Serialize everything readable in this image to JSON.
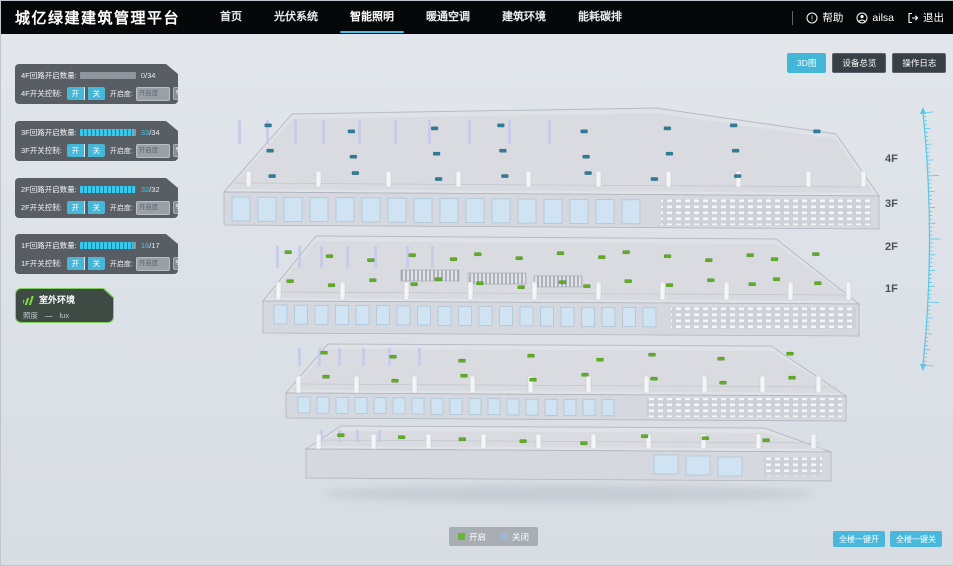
{
  "header": {
    "title": "城亿绿建建筑管理平台",
    "nav": [
      {
        "key": "home",
        "label": "首页",
        "active": false
      },
      {
        "key": "pv-system",
        "label": "光伏系统",
        "active": false
      },
      {
        "key": "smart-lighting",
        "label": "智能照明",
        "active": true
      },
      {
        "key": "hvac",
        "label": "暖通空调",
        "active": false
      },
      {
        "key": "building-env",
        "label": "建筑环境",
        "active": false
      },
      {
        "key": "energy-carbon",
        "label": "能耗碳排",
        "active": false
      }
    ],
    "help_label": "帮助",
    "username": "ailsa",
    "logout_label": "退出"
  },
  "view_buttons": [
    {
      "key": "view-3d",
      "label": "3D图",
      "active": true
    },
    {
      "key": "device-overview",
      "label": "设备总览",
      "active": false
    },
    {
      "key": "operation-log",
      "label": "操作日志",
      "active": false
    }
  ],
  "floor_controls": [
    {
      "key": "4f",
      "circuit_label": "4F回路开启数量:",
      "open_count": 0,
      "total": 34,
      "total_text": "/34",
      "switch_label": "4F开关控制:",
      "on_label": "开",
      "off_label": "关",
      "openness_label": "开启度:",
      "openness_placeholder": "开启度",
      "percent_label": "%"
    },
    {
      "key": "3f",
      "circuit_label": "3F回路开启数量:",
      "open_count": 33,
      "total": 34,
      "total_text": "/34",
      "switch_label": "3F开关控制:",
      "on_label": "开",
      "off_label": "关",
      "openness_label": "开启度:",
      "openness_placeholder": "开启度",
      "percent_label": "%"
    },
    {
      "key": "2f",
      "circuit_label": "2F回路开启数量:",
      "open_count": 32,
      "total": 32,
      "total_text": "/32",
      "switch_label": "2F开关控制:",
      "on_label": "开",
      "off_label": "关",
      "openness_label": "开启度:",
      "openness_placeholder": "开启度",
      "percent_label": "%"
    },
    {
      "key": "1f",
      "circuit_label": "1F回路开启数量:",
      "open_count": 16,
      "total": 17,
      "total_text": "/17",
      "switch_label": "1F开关控制:",
      "on_label": "开",
      "off_label": "关",
      "openness_label": "开启度:",
      "openness_placeholder": "开启度",
      "percent_label": "%"
    }
  ],
  "outdoor": {
    "title": "室外环境",
    "illuminance_label": "照度",
    "illuminance_value": "—",
    "illuminance_unit": "lux"
  },
  "floor_scale_labels": [
    "4F",
    "3F",
    "2F",
    "1F"
  ],
  "legend": [
    {
      "key": "on",
      "label": "开启",
      "color": "#6ab437"
    },
    {
      "key": "off",
      "label": "关闭",
      "color": "#9cb8d8"
    }
  ],
  "bulk_buttons": [
    {
      "key": "all-on",
      "label": "全楼一键开"
    },
    {
      "key": "all-off",
      "label": "全楼一键关"
    }
  ],
  "colors": {
    "accent": "#44b7d8",
    "progress": "#3cc6ea",
    "header_bg": "#060708",
    "marker_on": "#5fae1f",
    "marker_off": "#2e7d9b",
    "panel_bg": "rgba(66,71,78,0.86)"
  },
  "building": {
    "floors": [
      {
        "label": "4F",
        "marker_color": "#2e7d9b",
        "marker_count": 22
      },
      {
        "label": "3F",
        "marker_color": "#5fae1f",
        "marker_count": 30
      },
      {
        "label": "2F",
        "marker_color": "#5fae1f",
        "marker_count": 16
      },
      {
        "label": "1F",
        "marker_color": "#5fae1f",
        "marker_count": 8
      }
    ]
  }
}
